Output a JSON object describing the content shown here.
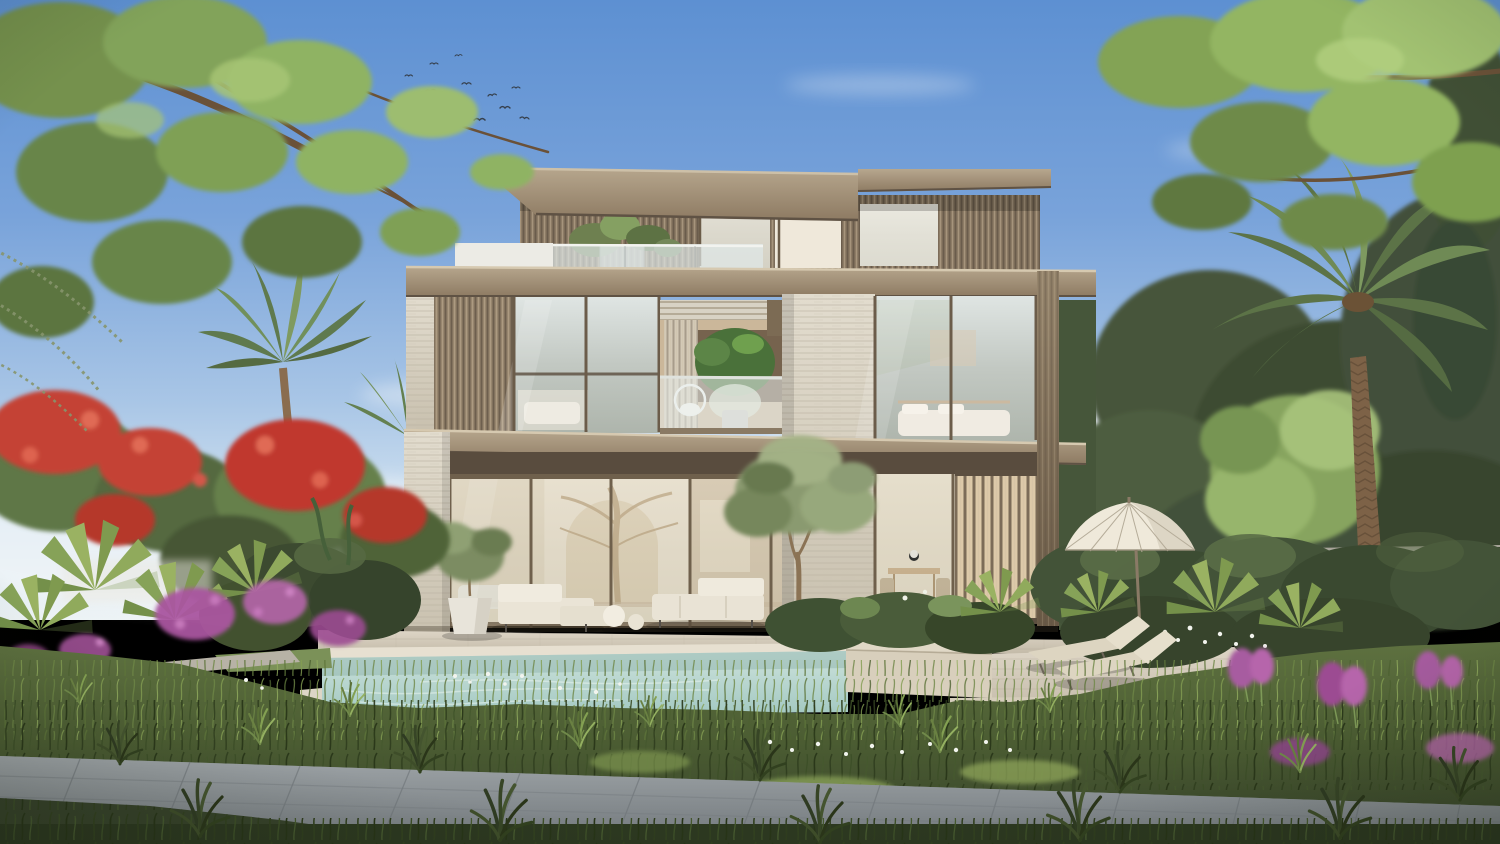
{
  "scene": {
    "type": "architectural-exterior-render",
    "description": "Photorealistic daytime rendering of a modern three-storey villa with stacked roof slabs, bronze louvre screens, travertine piers, floor-to-ceiling glazing, roof-terrace planters, a linear pool with raised spa ledge, sun deck with two loungers and a parasol, framed by palms, a red flame tree, magenta bougainvillea, ornamental grasses and a stone walkway under a blue sky with a flock of birds.",
    "palette": {
      "sky_top": "#5d90d2",
      "sky_horizon": "#edf3f5",
      "cloud_white": "#f7f9fa",
      "canopy_light": "#9cbb6e",
      "canopy_mid": "#7fa055",
      "canopy_dark": "#55693c",
      "palm_frond": "#6f8a55",
      "flame_tree_red": "#c44335",
      "bougainvillea_magenta": "#a9559f",
      "roof_slab_bronze": "#a4937b",
      "louvre_bronze": "#8d7c66",
      "travertine": "#d9d3c5",
      "glass_cool": "#c5ccc6",
      "interior_warm": "#e3d5bd",
      "pool_water": "#bcd8d2",
      "spa_stone": "#e0d8c6",
      "deck_paver": "#d5cdbe",
      "path_grey": "#8f9599",
      "grass_dark": "#3d4b2a",
      "grass_mid": "#5e7140",
      "grass_light": "#8aa35c",
      "flower_white": "#f2f4ee",
      "umbrella_canvas": "#efe9da",
      "lounger_cushion": "#ddd5c1",
      "trunk_brown": "#7d6247",
      "bird_dark": "#36404d"
    },
    "counts": {
      "storeys": 3,
      "sun_loungers": 2,
      "parasols": 1,
      "outdoor_sofas": 2,
      "planter_pots": 2,
      "large_palms": 3,
      "birds_in_flock": 14
    }
  }
}
